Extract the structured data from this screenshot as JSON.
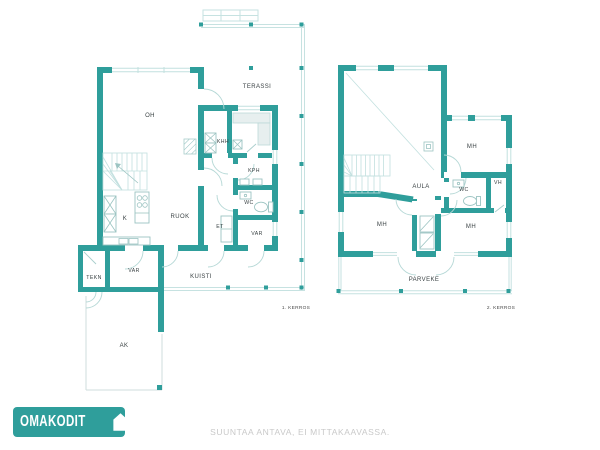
{
  "canvas": {
    "width": 600,
    "height": 450,
    "background": "#FFFFFF"
  },
  "colors": {
    "wall_teal": "#2F9E9B",
    "light_line": "#C2E0DF",
    "fixture_line": "#9CC4C2",
    "label_text": "#3B4345",
    "caption_text": "#4A4A4A",
    "disclaimer_text": "#C9C9C9",
    "logo_background": "#2F9E9B",
    "logo_text": "#FFFFFF"
  },
  "floor1": {
    "caption": "1. KERROS",
    "rooms": {
      "oh": "OH",
      "terassi": "TERASSI",
      "khh": "KHH",
      "kph": "KPH",
      "wc": "WC",
      "k": "K",
      "ruok": "RUOK",
      "et": "ET",
      "var_entry": "VAR",
      "tekn": "TEKN",
      "var_storage": "VAR",
      "kuisti": "KUISTI",
      "ak": "AK"
    }
  },
  "floor2": {
    "caption": "2. KERROS",
    "rooms": {
      "mh_top": "MH",
      "aula": "AULA",
      "wc": "WC",
      "vh": "VH",
      "mh_left": "MH",
      "mh_right": "MH",
      "parveke": "PARVEKE"
    }
  },
  "footer": {
    "brand": "OMAKODIT",
    "disclaimer": "SUUNTAA ANTAVA, EI MITTAKAAVASSA."
  }
}
